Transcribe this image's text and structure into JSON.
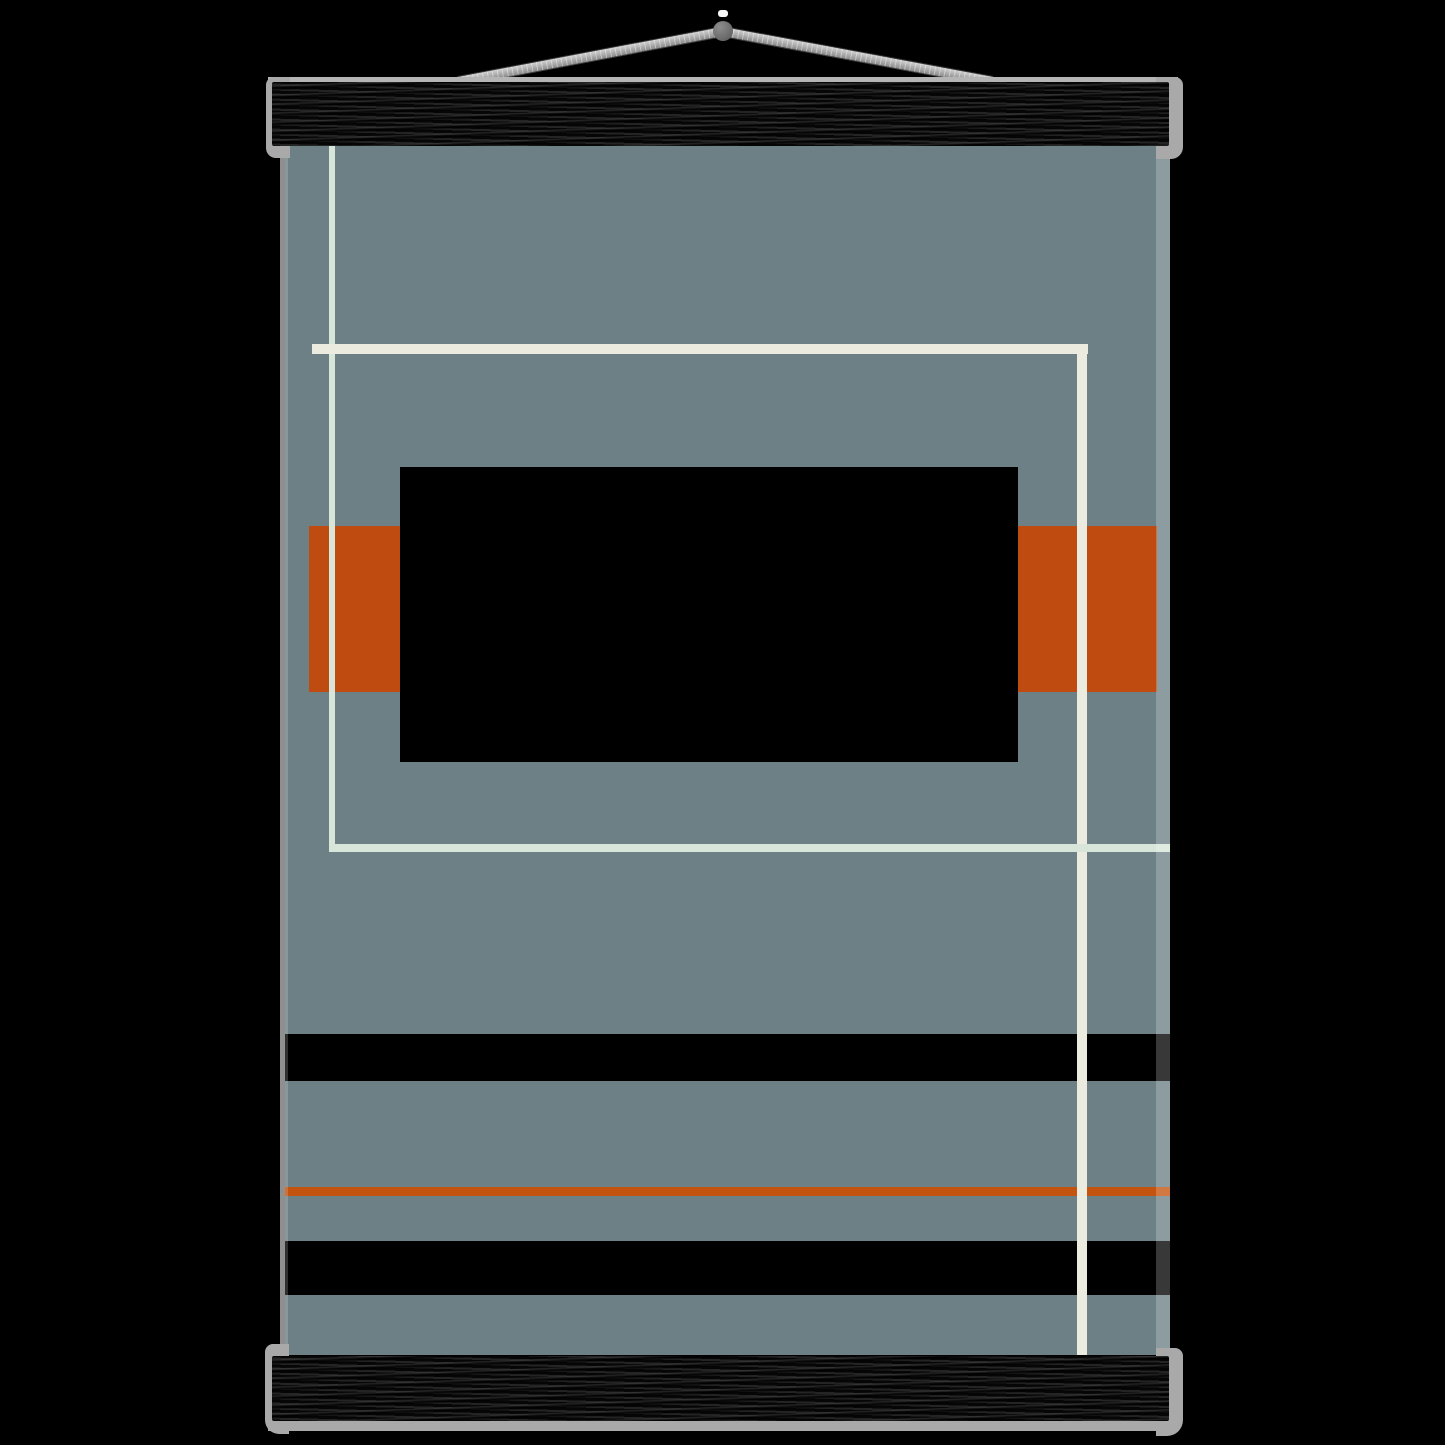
{
  "scene": {
    "type": "poster-mockup",
    "description": "Abstract bauhaus-style geometric art print hanging on black wooden magnetic poster hangers with silver aluminium rails and a grey twine cord on a black background",
    "text_content": []
  },
  "colors": {
    "background": "#000000",
    "poster": "#6d8086",
    "orange": "#bf4b10",
    "orange_rule": "#c4530f",
    "mint": "#d7e6d9",
    "cream": "#ecebdf",
    "black": "#000000",
    "wood": "#181818",
    "rail": "#a9a9a9",
    "rail_light": "#b5b5b5",
    "cord": "#b9b9b9",
    "cord_dark": "#8a8a8a",
    "knob": "#6d6d6d"
  },
  "artwork": {
    "elements": [
      "mint-vertical-line",
      "cream-horizontal-line",
      "cream-vertical-line",
      "mint-horizontal-line",
      "orange-band",
      "black-rectangle",
      "black-stripe-1",
      "orange-rule",
      "black-stripe-2"
    ]
  }
}
